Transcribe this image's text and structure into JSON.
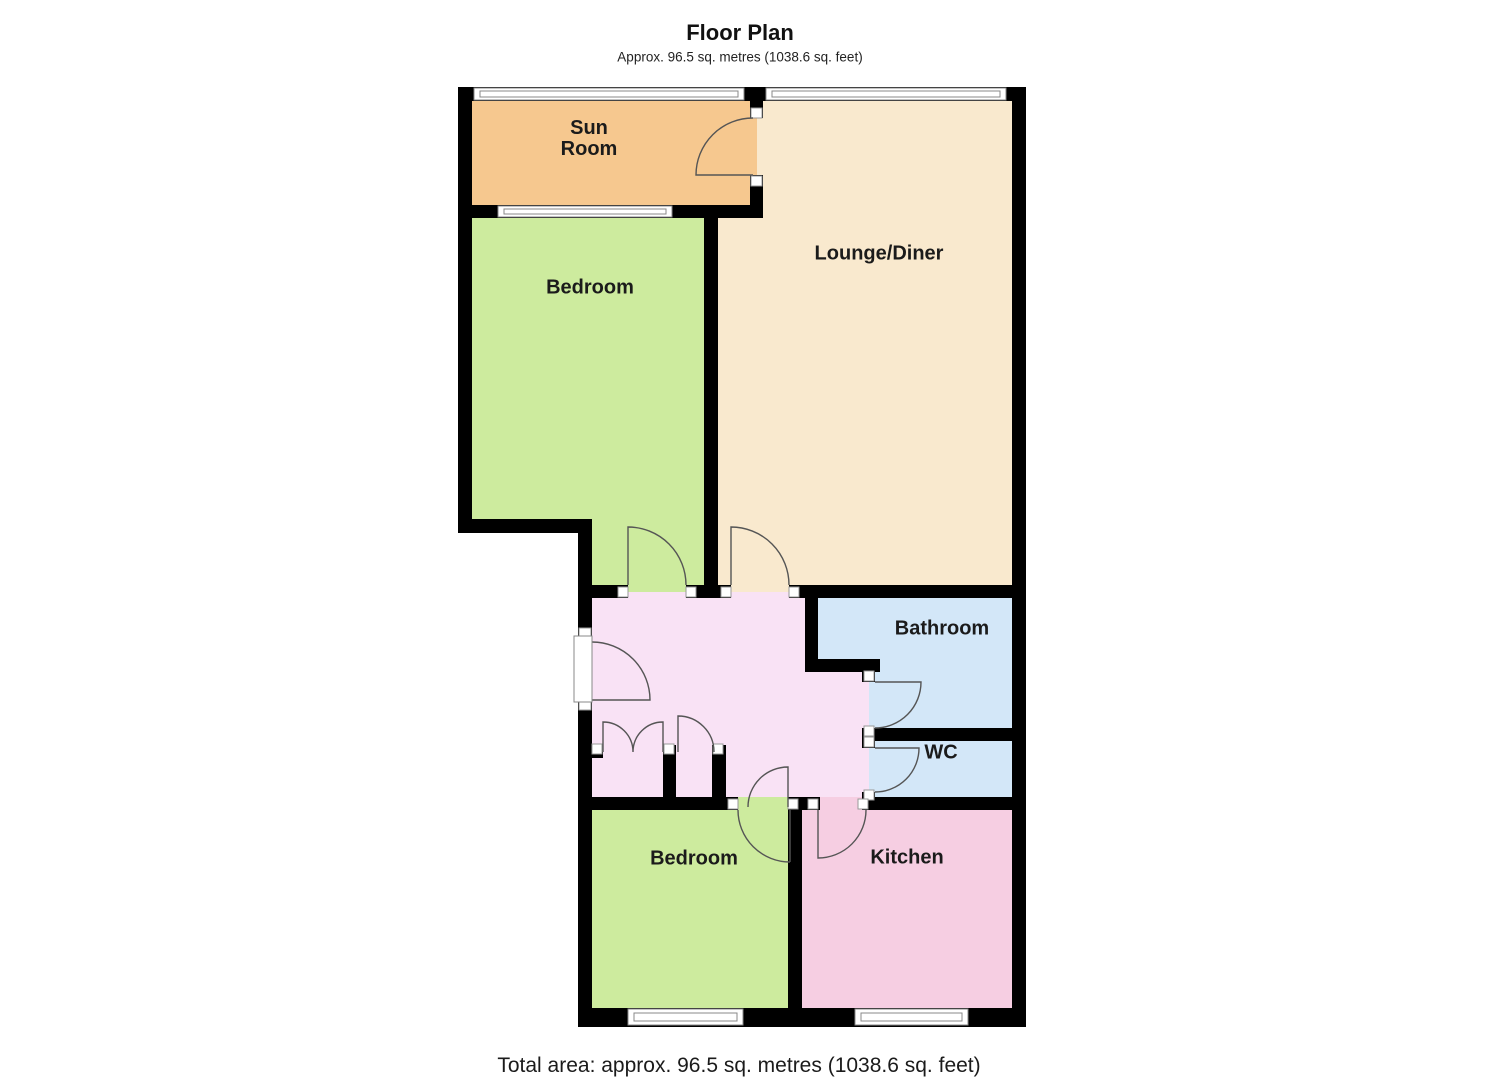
{
  "header": {
    "title": "Floor Plan",
    "subtitle": "Approx. 96.5 sq. metres (1038.6 sq. feet)"
  },
  "footer": {
    "total_area": "Total area: approx. 96.5 sq. metres (1038.6 sq. feet)"
  },
  "rooms": {
    "sun_room": {
      "label_line1": "Sun",
      "label_line2": "Room",
      "color": "#F6C88F"
    },
    "lounge_diner": {
      "label": "Lounge/Diner",
      "color": "#F9E9CE"
    },
    "bedroom_top": {
      "label": "Bedroom",
      "color": "#CDEB9E"
    },
    "hallway": {
      "color": "#F9E2F5"
    },
    "bathroom": {
      "label": "Bathroom",
      "color": "#D3E7F8"
    },
    "wc": {
      "label": "WC",
      "color": "#D3E7F8"
    },
    "bedroom_bottom": {
      "label": "Bedroom",
      "color": "#CDEB9E"
    },
    "kitchen": {
      "label": "Kitchen",
      "color": "#F6CEE2"
    }
  },
  "style": {
    "wall_color": "#000000",
    "door_stroke": "#555555",
    "window_stroke": "#888888",
    "jamb_stroke": "#999999"
  }
}
